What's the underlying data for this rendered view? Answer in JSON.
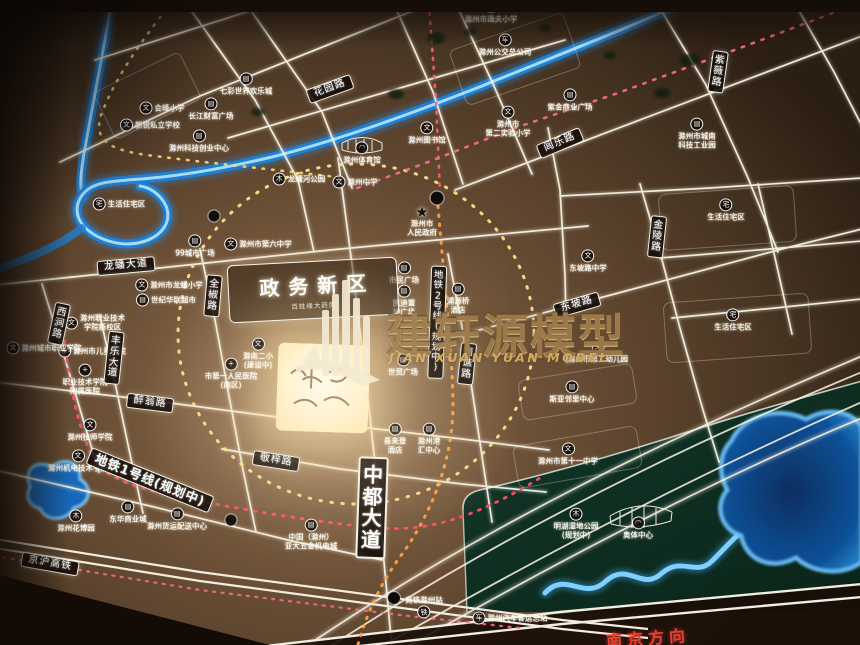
{
  "title": "滁州政务新区区位图（沙盘模型照片）",
  "watermark": {
    "cn": "建轩源模型",
    "en": "JIAN XUAN YUAN MODEL"
  },
  "district_box": {
    "label": "政务新区",
    "sub": "百姓缘大药房"
  },
  "direction_label": "南京方向",
  "colors": {
    "board": "#6e523a",
    "road": "#f7f2e8",
    "river": "#2f9be8",
    "green_area": "#0e2f20",
    "lake": "#0a3e7c",
    "ring_dash": "#ffd878",
    "metro2_dash": "#ffa13d",
    "metro1_dash": "#ff5f7d"
  },
  "icon_glyphs": {
    "school": "文",
    "biz": "▤",
    "hosp": "+",
    "home": "宅",
    "park": "木",
    "bus": "车",
    "rail": "铁",
    "gov": "★",
    "stadium": "◠"
  },
  "road_labels": [
    {
      "t": "花园路",
      "x": 330,
      "y": 89,
      "rot": -20
    },
    {
      "t": "闾乐路",
      "x": 560,
      "y": 143,
      "rot": -23
    },
    {
      "t": "紫薇路",
      "x": 718,
      "y": 72,
      "rot": 8,
      "v": true
    },
    {
      "t": "金陵路",
      "x": 657,
      "y": 237,
      "rot": 6,
      "v": true
    },
    {
      "t": "东坡路",
      "x": 577,
      "y": 305,
      "rot": -16
    },
    {
      "t": "龙蟠大道",
      "x": 126,
      "y": 266,
      "rot": -5
    },
    {
      "t": "全椒路",
      "x": 213,
      "y": 296,
      "rot": 5,
      "v": true
    },
    {
      "t": "西涧路",
      "x": 59,
      "y": 324,
      "rot": 12,
      "v": true
    },
    {
      "t": "丰乐大道",
      "x": 114,
      "y": 358,
      "rot": 6,
      "v": true
    },
    {
      "t": "醉翁路",
      "x": 150,
      "y": 403,
      "rot": 7
    },
    {
      "t": "敬梓路",
      "x": 276,
      "y": 461,
      "rot": 9
    },
    {
      "t": "南谯路",
      "x": 467,
      "y": 364,
      "rot": 6,
      "v": true
    },
    {
      "t": "中都大道",
      "x": 372,
      "y": 508,
      "rot": 2,
      "v": true,
      "cls": "big"
    },
    {
      "t": "地铁2号线(规划中)",
      "x": 437,
      "y": 322,
      "rot": 2,
      "v": true,
      "cls": "metro2"
    },
    {
      "t": "地铁1号线(规划中)",
      "x": 150,
      "y": 480,
      "rot": 22,
      "cls": "metro"
    },
    {
      "t": "京沪高铁",
      "x": 50,
      "y": 564,
      "rot": 10
    }
  ],
  "pois": [
    {
      "t": "会峰小学",
      "ic": "school",
      "x": 162,
      "y": 108,
      "il": 1
    },
    {
      "t": "新锐私立学校",
      "ic": "school",
      "x": 150,
      "y": 125,
      "il": 1
    },
    {
      "t": "长江财富广场",
      "ic": "biz",
      "x": 211,
      "y": 109
    },
    {
      "t": "七彩世界欢乐城",
      "ic": "biz",
      "x": 246,
      "y": 84
    },
    {
      "t": "滁州科技创业中心",
      "ic": "biz",
      "x": 199,
      "y": 141
    },
    {
      "t": "滁州市逸夫小学",
      "ic": "school",
      "x": 491,
      "y": 12
    },
    {
      "t": "滁州公交总公司",
      "ic": "bus",
      "x": 505,
      "y": 45
    },
    {
      "t": "紫金商业广场",
      "ic": "biz",
      "x": 570,
      "y": 100
    },
    {
      "t": "滁州市\n第二实验小学",
      "ic": "school",
      "x": 508,
      "y": 122
    },
    {
      "t": "滁州市城南\n科技工业园",
      "ic": "biz",
      "x": 697,
      "y": 134
    },
    {
      "t": "滁州图书馆",
      "ic": "school",
      "x": 427,
      "y": 133
    },
    {
      "t": "滁州体育馆",
      "ic": "stadium",
      "x": 362,
      "y": 153
    },
    {
      "t": "龙蟠河公园",
      "ic": "park",
      "x": 299,
      "y": 179,
      "il": 1
    },
    {
      "t": "滁州中学",
      "ic": "school",
      "x": 355,
      "y": 182,
      "il": 1
    },
    {
      "t": "生活住宅区",
      "ic": "home",
      "x": 119,
      "y": 204,
      "il": 1
    },
    {
      "t": "生活住宅区",
      "ic": "home",
      "x": 726,
      "y": 210
    },
    {
      "t": "生活住宅区",
      "ic": "home",
      "x": 733,
      "y": 320
    },
    {
      "t": "99城市广场",
      "ic": "biz",
      "x": 195,
      "y": 246
    },
    {
      "t": "滁州市第六中学",
      "ic": "school",
      "x": 258,
      "y": 244,
      "il": 1
    },
    {
      "t": "滁州市龙蟠小学",
      "ic": "school",
      "x": 169,
      "y": 285,
      "il": 1
    },
    {
      "t": "世纪华联超市",
      "ic": "biz",
      "x": 166,
      "y": 300,
      "il": 1
    },
    {
      "t": "滁州市\n人民政府",
      "ic": "gov",
      "x": 422,
      "y": 222
    },
    {
      "t": "东坡路中学",
      "ic": "school",
      "x": 588,
      "y": 261
    },
    {
      "t": "市民广场",
      "ic": "biz",
      "x": 404,
      "y": 273
    },
    {
      "t": "凯迪置\n地广场",
      "ic": "biz",
      "x": 404,
      "y": 301
    },
    {
      "t": "浦源桥\n酒店",
      "ic": "biz",
      "x": 458,
      "y": 299
    },
    {
      "t": "滁南二小\n(建设中)",
      "ic": "school",
      "x": 258,
      "y": 354
    },
    {
      "t": "市第一人民医院\n(南区)",
      "ic": "hosp",
      "x": 231,
      "y": 374
    },
    {
      "t": "滁州职业技术\n学院新校区",
      "ic": "school",
      "x": 95,
      "y": 323,
      "il": 1
    },
    {
      "t": "滁州市儿童医院",
      "ic": "hosp",
      "x": 92,
      "y": 351,
      "il": 1
    },
    {
      "t": "滁州城市职业学院",
      "ic": "school",
      "x": 44,
      "y": 348,
      "il": 1
    },
    {
      "t": "职业技术学院\n附属医院",
      "ic": "hosp",
      "x": 85,
      "y": 380
    },
    {
      "t": "滁州技师学院",
      "ic": "school",
      "x": 90,
      "y": 430
    },
    {
      "t": "滁州机电技术学院",
      "ic": "school",
      "x": 78,
      "y": 461
    },
    {
      "t": "喜来登\n酒店",
      "ic": "biz",
      "x": 395,
      "y": 439
    },
    {
      "t": "滁州港\n汇中心",
      "ic": "biz",
      "x": 429,
      "y": 439
    },
    {
      "t": "世贸广场",
      "ic": "biz",
      "x": 403,
      "y": 365
    },
    {
      "t": "斯亚邻里中心",
      "ic": "biz",
      "x": 572,
      "y": 392
    },
    {
      "t": "滁州市第十一中学",
      "ic": "school",
      "x": 568,
      "y": 454
    },
    {
      "t": "明湖湿地公园\n(规划中)",
      "ic": "park",
      "x": 576,
      "y": 524
    },
    {
      "t": "奥体中心",
      "ic": "stadium",
      "x": 638,
      "y": 528
    },
    {
      "t": "滁州花博园",
      "ic": "park",
      "x": 76,
      "y": 521
    },
    {
      "t": "东华商业城",
      "ic": "biz",
      "x": 128,
      "y": 512
    },
    {
      "t": "滁州货运配送中心",
      "ic": "biz",
      "x": 177,
      "y": 519
    },
    {
      "t": "中国（滁州）\n亚大五金机电城",
      "ic": "biz",
      "x": 311,
      "y": 535
    },
    {
      "t": "高铁滁州站",
      "ic": "rail",
      "x": 424,
      "y": 607,
      "ib": 1
    },
    {
      "t": "滁州汽车客运总站",
      "ic": "bus",
      "x": 510,
      "y": 618,
      "il": 1
    },
    {
      "t": "滁州市第二幼儿园",
      "ic": "school",
      "x": 598,
      "y": 352
    }
  ]
}
